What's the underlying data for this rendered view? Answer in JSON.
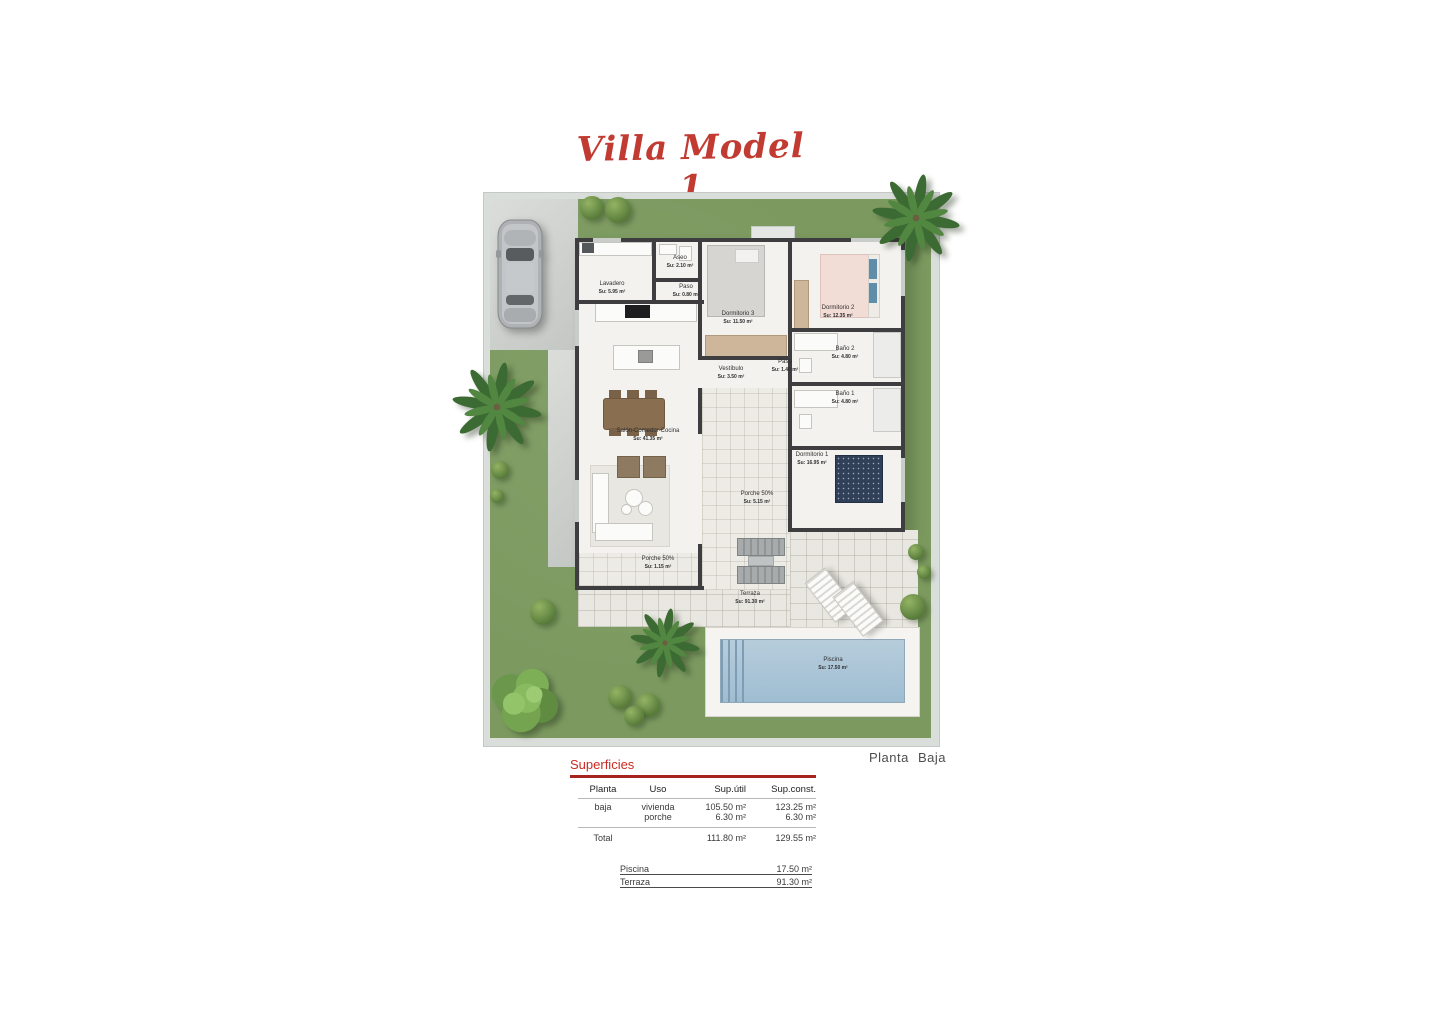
{
  "title": "Villa Model 1",
  "plan": {
    "caption": "Planta Baja",
    "rooms": [
      {
        "name": "Lavadero",
        "area": "Su: 5.95 m²"
      },
      {
        "name": "Aseo",
        "area": "Su: 2.10 m²"
      },
      {
        "name": "Paso",
        "area": "Su: 0.80 m²"
      },
      {
        "name": "Dormitorio 3",
        "area": "Su: 11.50 m²"
      },
      {
        "name": "Dormitorio 2",
        "area": "Su: 12.35 m²"
      },
      {
        "name": "Baño 2",
        "area": "Su: 4.80 m²"
      },
      {
        "name": "Paso",
        "area": "Su: 1.40 m²"
      },
      {
        "name": "Baño 1",
        "area": "Su: 4.80 m²"
      },
      {
        "name": "Vestíbulo",
        "area": "Su: 3.50 m²"
      },
      {
        "name": "Salón-Comedor-Cocina",
        "area": "Su: 41.35 m²"
      },
      {
        "name": "Dormitorio 1",
        "area": "Su: 16.95 m²"
      },
      {
        "name": "Porche 50%",
        "area": "Su: 5.15 m²"
      },
      {
        "name": "Porche 50%",
        "area": "Su: 1.15 m²"
      },
      {
        "name": "Terraza",
        "area": "Su: 91.30 m²"
      },
      {
        "name": "Piscina",
        "area": "Su: 17.50 m²"
      }
    ]
  },
  "surfaces": {
    "title": "Superficies",
    "headers": [
      "Planta",
      "Uso",
      "Sup.útil",
      "Sup.const."
    ],
    "rows": [
      {
        "planta": "baja",
        "uso": "vivienda",
        "util": "105.50 m²",
        "const": "123.25 m²"
      },
      {
        "planta": "",
        "uso": "porche",
        "util": "6.30 m²",
        "const": "6.30 m²"
      }
    ],
    "total": {
      "label": "Total",
      "util": "111.80 m²",
      "const": "129.55 m²"
    },
    "extras": [
      {
        "label": "Piscina",
        "value": "17.50 m²"
      },
      {
        "label": "Terraza",
        "value": "91.30 m²"
      }
    ]
  },
  "colors": {
    "title_red": "#c23b32",
    "accent_underline": "#a5241f",
    "lawn_green": "#7c9a60",
    "wall_dark": "#3e3e40",
    "pool_blue": "#a9c3d6"
  }
}
